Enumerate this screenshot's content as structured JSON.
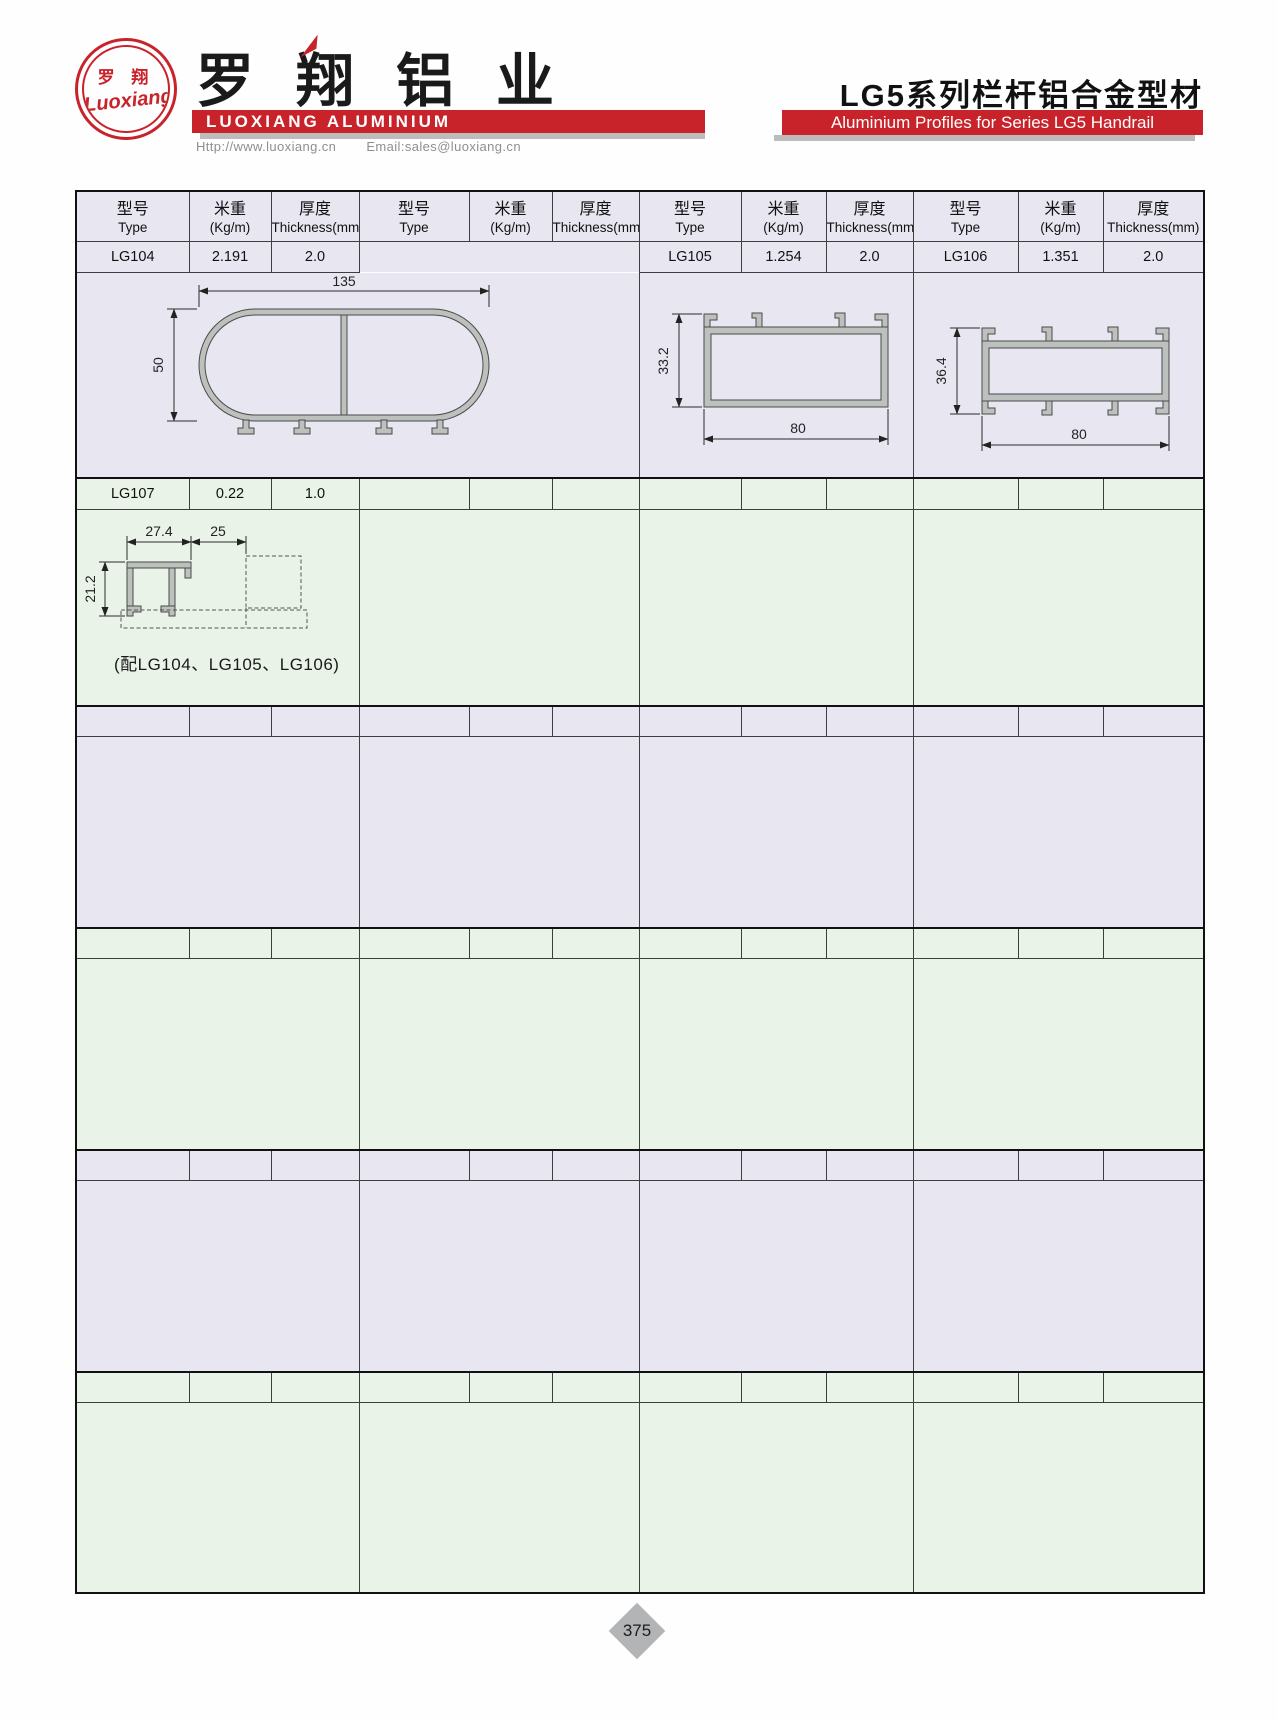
{
  "header": {
    "logo_cn": "罗 翔",
    "logo_script": "Luoxiang",
    "company_cn": "罗翔铝业",
    "company_en": "LUOXIANG ALUMINIUM",
    "website": "Http://www.luoxiang.cn",
    "email": "Email:sales@luoxiang.cn",
    "series_cn": "LG5系列栏杆铝合金型材",
    "series_en": "Aluminium Profiles for Series LG5 Handrail"
  },
  "colors": {
    "brand_red": "#c8232a",
    "section_lavender": "#e7e6f1",
    "section_green": "#eaf3e8",
    "profile_gray": "#bdc1bd"
  },
  "table": {
    "headers": {
      "type_cn": "型号",
      "type_en": "Type",
      "weight_cn": "米重",
      "weight_en": "(Kg/m)",
      "thickness_cn": "厚度",
      "thickness_en": "Thickness(mm)"
    },
    "row1": {
      "g1": {
        "type": "LG104",
        "weight": "2.191",
        "thickness": "2.0"
      },
      "g3": {
        "type": "LG105",
        "weight": "1.254",
        "thickness": "2.0"
      },
      "g4": {
        "type": "LG106",
        "weight": "1.351",
        "thickness": "2.0"
      }
    },
    "row2": {
      "g1": {
        "type": "LG107",
        "weight": "0.22",
        "thickness": "1.0"
      }
    }
  },
  "drawings": {
    "lg104": {
      "dim_width": "135",
      "dim_height": "50"
    },
    "lg105": {
      "dim_height": "33.2",
      "dim_width": "80"
    },
    "lg106": {
      "dim_height": "36.4",
      "dim_width": "80"
    },
    "lg107": {
      "dim_top_left": "27.4",
      "dim_top_right": "25",
      "dim_left": "21.2",
      "caption": "(配LG104、LG105、LG106)"
    }
  },
  "footer": {
    "page": "375"
  }
}
